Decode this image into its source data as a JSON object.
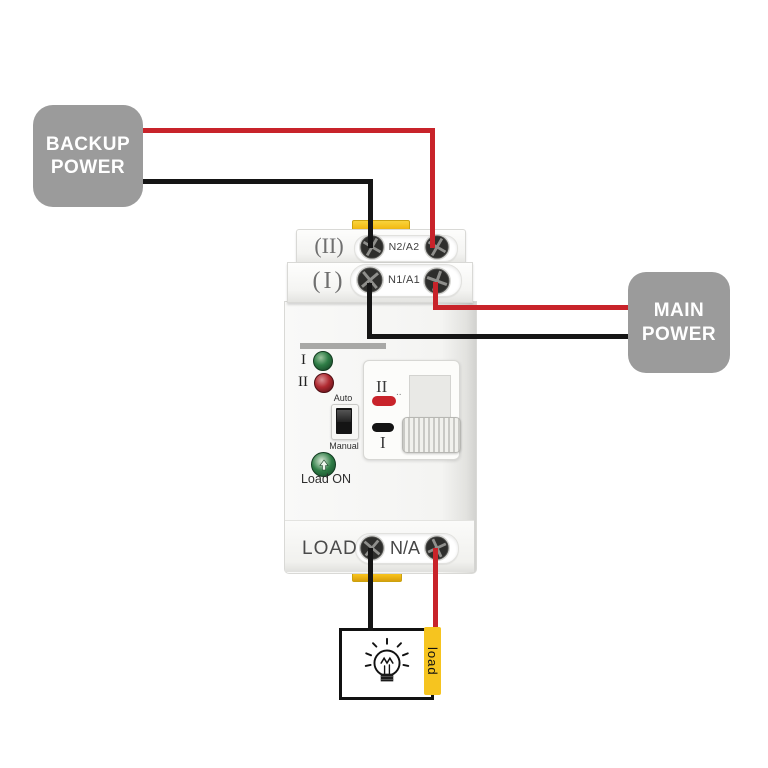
{
  "boxes": {
    "backup": {
      "line1": "BACKUP",
      "line2": "POWER"
    },
    "main": {
      "line1": "MAIN",
      "line2": "POWER"
    }
  },
  "device": {
    "input2": {
      "row_label": "(II)",
      "terminal_label": "N2/A2"
    },
    "input1": {
      "row_label": "(I)",
      "terminal_label": "N1/A1"
    },
    "indicators": {
      "led1": "I",
      "led2": "II"
    },
    "mode": {
      "auto": "Auto",
      "manual": "Manual"
    },
    "load_on": "Load ON",
    "switch_panel": {
      "top": "II",
      "dots": "..",
      "bottom": "I"
    },
    "output": {
      "load": "LOAD",
      "na": "N/A"
    }
  },
  "load_tag": "load",
  "colors": {
    "wire_red": "#c8232a",
    "wire_black": "#151515",
    "power_box_gray": "#9b9b9b",
    "clip_yellow": "#f3bd19",
    "tag_yellow": "#f6c41f",
    "led_green": "#2e7d46",
    "led_red": "#b02a31",
    "indicator_red": "#c8232a",
    "indicator_black": "#141414",
    "device_body": "#f4f4f2"
  },
  "icons": [
    "screw-terminal-icon",
    "light-bulb-icon",
    "arrow-up-icon",
    "toggle-switch",
    "led-indicator"
  ]
}
